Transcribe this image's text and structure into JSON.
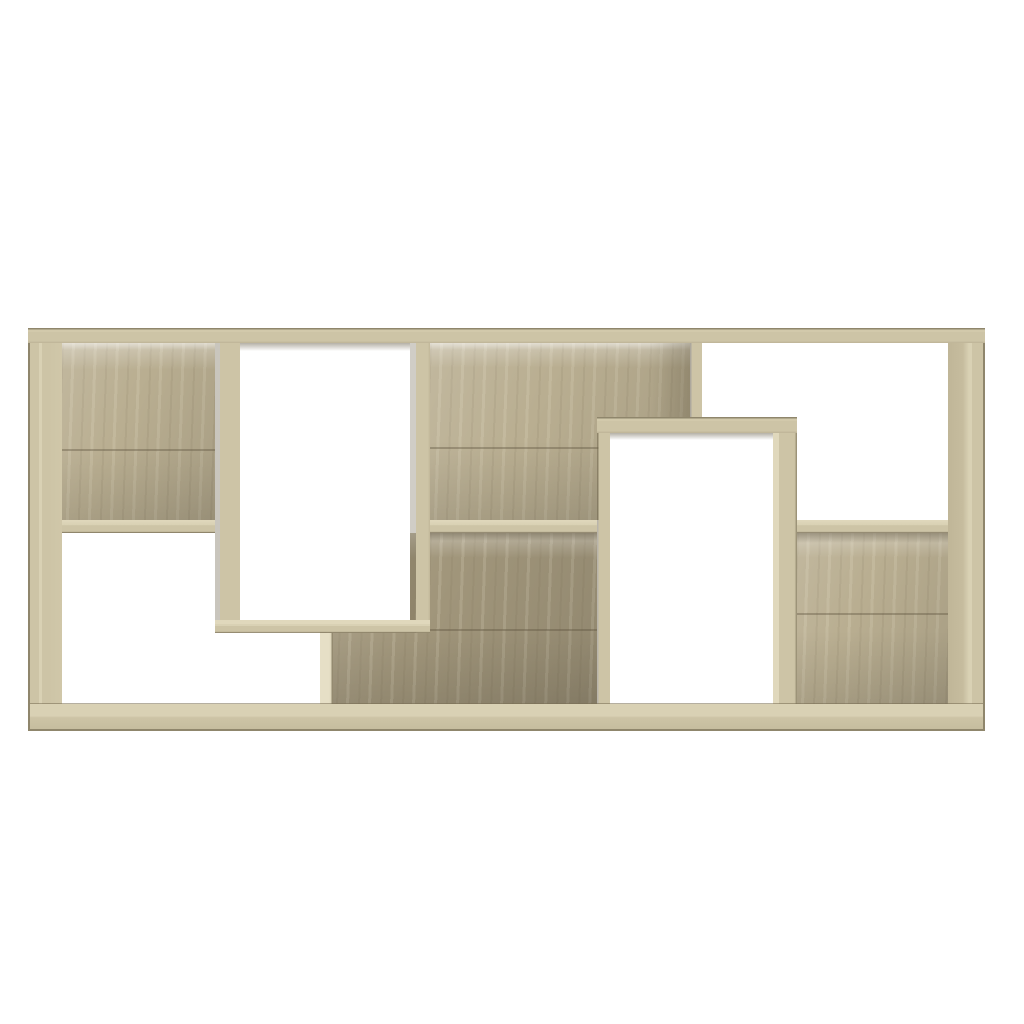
{
  "scene": {
    "type": "product-photo",
    "subject": "geometric cube wall bookshelf, front view",
    "material_finish": "sonoma oak engineered wood",
    "background_color": "#ffffff",
    "open_compartments": 4,
    "backed_compartments": 4,
    "structure": [
      "top-left cubby with wood back panel",
      "tall protruding rectangular frame left-of-center, open through",
      "center back-panelled columns above and below middle shelf",
      "second protruding rectangular frame right-of-center, open through",
      "top-right open cubby",
      "bottom-right cubby with wood back panel",
      "bottom-left open cubby",
      "continuous base board and top rail"
    ]
  },
  "palette": {
    "background": "#ffffff",
    "wood_face": "#cdc4a6",
    "wood_face_light": "#d9d1b4",
    "wood_panel": "#b9ae91",
    "wood_panel_dark": "#a1967b",
    "wood_shadow": "#958b72",
    "wood_edge": "#8f866c",
    "wood_highlight": "#e0d8bc"
  }
}
